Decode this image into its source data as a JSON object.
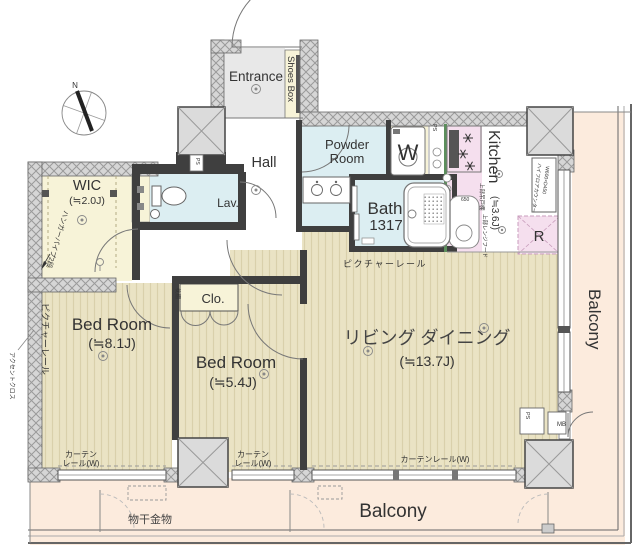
{
  "rooms": {
    "entrance": {
      "label": "Entrance"
    },
    "shoes_box": {
      "label": "Shoes Box"
    },
    "hall": {
      "label": "Hall"
    },
    "powder_room": {
      "label_line1": "Powder",
      "label_line2": "Room"
    },
    "laundry": {
      "label": "W"
    },
    "kitchen": {
      "label": "Kitchen",
      "size": "(≒3.6J)"
    },
    "bath": {
      "label": "Bath",
      "size": "1317"
    },
    "refrigerator": {
      "label": "R"
    },
    "wic": {
      "label": "WIC",
      "size": "(≒2.0J)"
    },
    "lavatory": {
      "label": "Lav."
    },
    "closet": {
      "label": "Clo."
    },
    "bedroom_1": {
      "label": "Bed Room",
      "size": "(≒8.1J)"
    },
    "bedroom_2": {
      "label": "Bed Room",
      "size": "(≒5.4J)"
    },
    "living_dining": {
      "label": "リビング ダイニング",
      "size": "(≒13.7J)"
    },
    "balcony_side": {
      "label": "Balcony"
    },
    "balcony_bottom": {
      "label": "Balcony"
    }
  },
  "annotations": {
    "compass_north": "N",
    "pipe_space": "PS",
    "meter_box": "MB",
    "laundry_hardware": "物干金物",
    "picture_rail": "ピクチャーレール",
    "curtain_rail_line1": "カーテン",
    "curtain_rail_line2": "レール(W)",
    "curtain_rail_full": "カーテンレール(W)",
    "hanger_pipe": "ハンガーパイプ2段",
    "accent_cloth": "アクセントクロス",
    "upper_cabinet": "上部吊戸棚",
    "upper_range_hood": "上部レンジフード",
    "counter_note_line1": "ハイフロアカウンター",
    "counter_note_line2": "W600×D450",
    "pillow_shelf": "枕棚",
    "sink_size": "650"
  },
  "colors": {
    "wood_floor": "#eae3c4",
    "wood_stripe": "#d9d0ab",
    "closet_yellow": "#f7f3d8",
    "wet_area_blue": "#dceef2",
    "kitchen_pink": "#f5dfee",
    "entrance_gray": "#e8e8e8",
    "balcony_peach": "#fcebdd",
    "wall_dark": "#3f3f3f",
    "hatch_wall_gray": "#d6d6d6",
    "pillar_gray": "#dbdbdb",
    "counter_edge_green": "#5c8f5c",
    "text": "#333333"
  }
}
